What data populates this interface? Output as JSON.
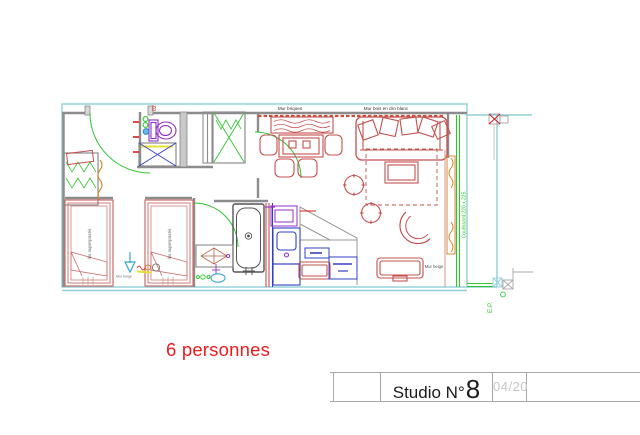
{
  "plan": {
    "labels": {
      "wall_top_left": "Mur briques",
      "wall_top_right": "Mur bois en clin blanc",
      "wall_right": "Mur beige",
      "wall_bottom": "Mur beige",
      "bunk_bed_left": "lits superposés",
      "bunk_bed_right": "lits superposés",
      "sliding_door": "Coulissant 220 x 225",
      "door_number": "02",
      "rainwater_pipe": "E.P."
    },
    "capacity_label": "6 personnes"
  },
  "title_block": {
    "name_label": "Studio N°",
    "unit_number": "8",
    "revision": "04/20"
  },
  "colors": {
    "boundary_cyan": "#8FD0D6",
    "door_green": "#2FC42F",
    "furniture_red": "#C4504E",
    "bed_pink": "#CC6B6B",
    "fixture_blue": "#3240C0",
    "sky_blue": "#35A8D8",
    "fixture_purple": "#9030C8",
    "curtain_orange": "#D88830",
    "wall_gray": "#8C8C8C",
    "capacity_red": "#ED1C1C",
    "revision_gray": "#C6C6C6"
  }
}
